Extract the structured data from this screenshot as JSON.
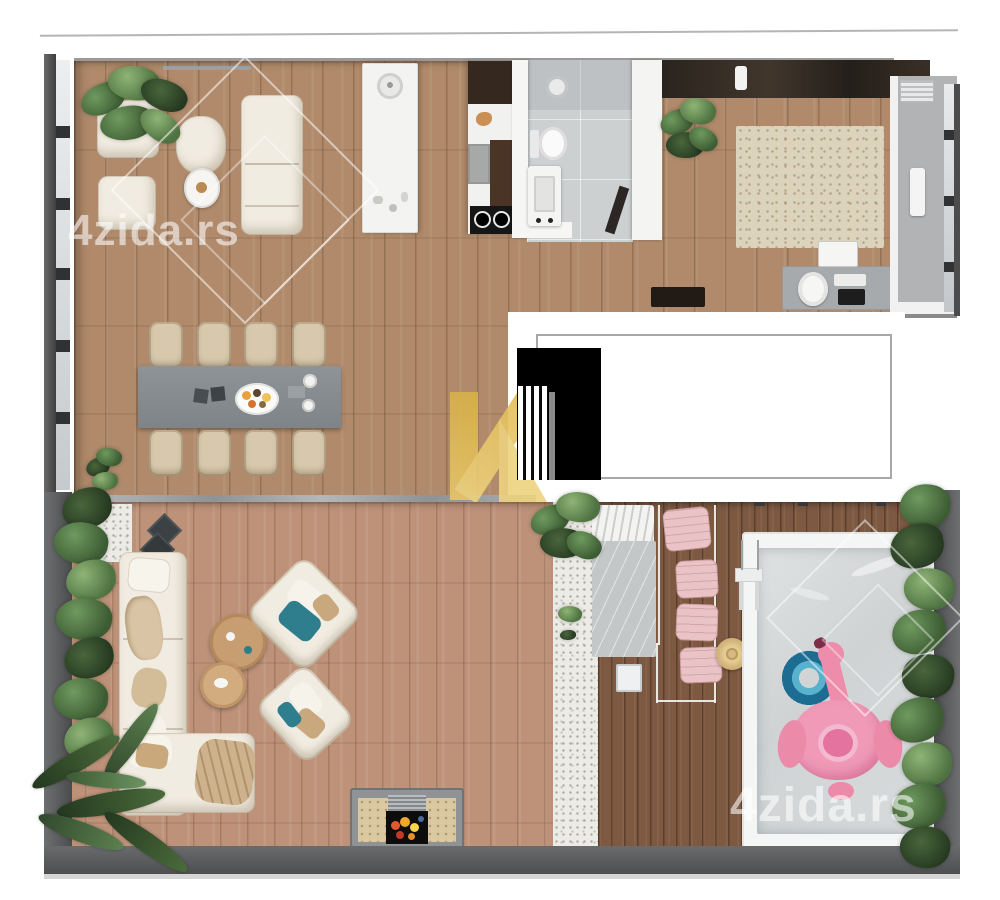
{
  "page": {
    "background": "#ffffff"
  },
  "watermarks": {
    "top_left": "4zida.rs",
    "bottom_right": "4zida.rs"
  },
  "logo": {
    "text": "NEKRETNINE",
    "mark": "n-monogram-gold"
  },
  "icons": {
    "plants": "potted-plant-icon",
    "pool_float": "flamingo-float-icon",
    "swim_ring": "swim-ring-icon",
    "fireplace": "fireplace-icon"
  },
  "colors": {
    "wood_interior": "#b08a6b",
    "wood_terrace": "#bd9279",
    "deck_wood": "#7d5942",
    "tile_gray": "#cdd0d1",
    "cream": "#f1ece1",
    "chair_beige": "#d8c9ae",
    "table_gray": "#868c90",
    "pool_water": "#d5d8d9",
    "ring_blue": "#2177a0",
    "flamingo_pink": "#f09ab8",
    "cushion_pink": "#eac3c6",
    "hedge_green": "#55774a",
    "gold": "#dfba56",
    "wall_dark": "#505356"
  }
}
